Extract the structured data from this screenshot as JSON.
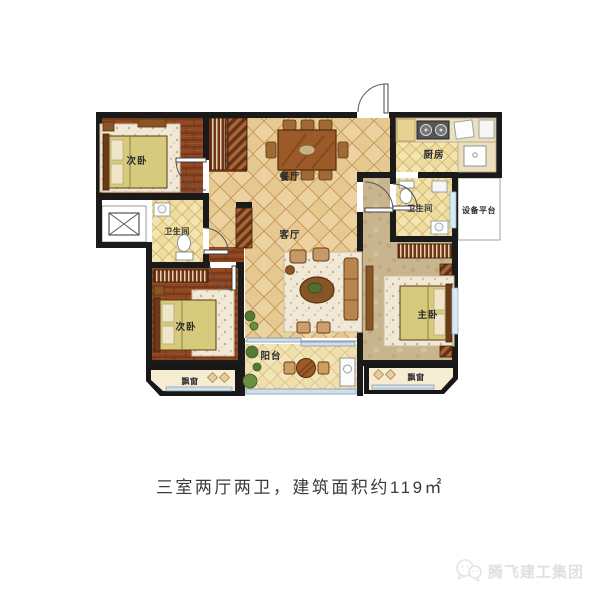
{
  "floor_plan": {
    "rooms": {
      "bedroom_top_left": "次卧",
      "bedroom_bottom_left": "次卧",
      "master_bedroom": "主卧",
      "dining_room": "餐厅",
      "living_room": "客厅",
      "kitchen": "厨房",
      "bathroom_left": "卫生间",
      "bathroom_right": "卫生间",
      "equipment_platform": "设备平台",
      "balcony": "阳台",
      "bay_window_left": "飘窗",
      "bay_window_right": "飘窗"
    }
  },
  "caption": "三室两厅两卫，建筑面积约119㎡",
  "watermark": {
    "brand": "腾飞建工集团",
    "icon": "wechat-chat-bubbles-icon"
  },
  "palette": {
    "wall": "#1a1a1a",
    "wood_floor": "#8c4722",
    "tile_floor": "#ecd2a0",
    "kitchen_bath_tile": "#f3e5b2",
    "master_floor": "#c8b48d",
    "bed_blanket": "#d6ca7c",
    "window_glass": "#cfe0ec",
    "caption_text": "#3a3a3a",
    "watermark_text": "#e0e0e0"
  }
}
